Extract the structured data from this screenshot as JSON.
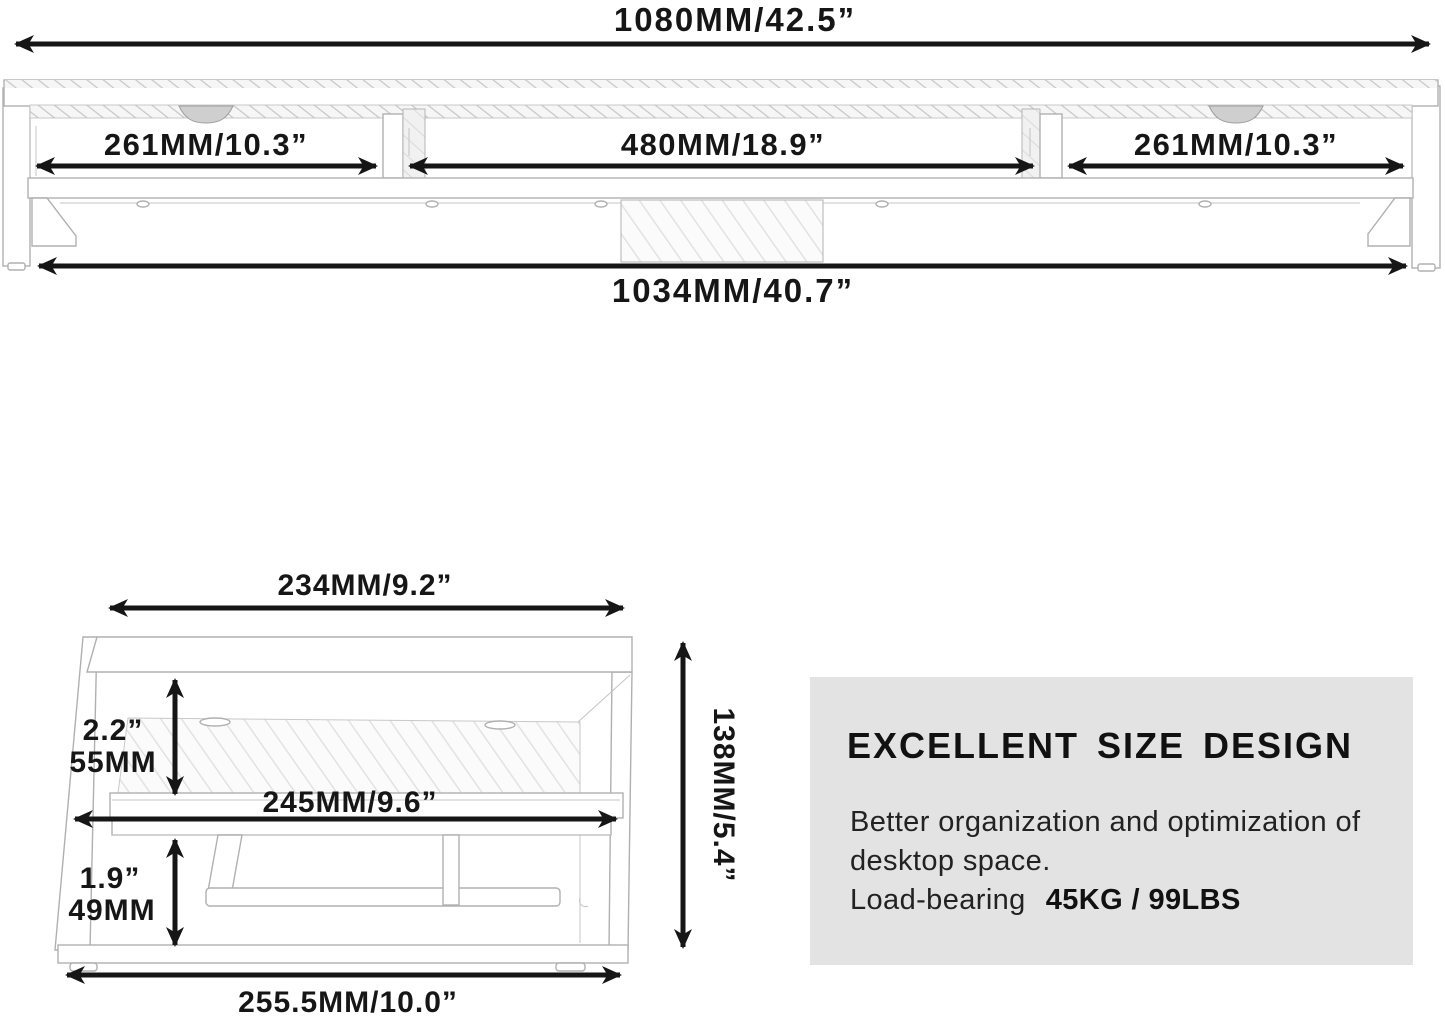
{
  "front_view": {
    "overall_width": "1080MM/42.5”",
    "left_compartment": "261MM/10.3”",
    "center_compartment": "480MM/18.9”",
    "right_compartment": "261MM/10.3”",
    "inner_width": "1034MM/40.7”"
  },
  "side_view": {
    "top_depth": "234MM/9.2”",
    "upper_clearance_in": "2.2”",
    "upper_clearance_mm": "55MM",
    "shelf_depth": "245MM/9.6”",
    "lower_clearance_in": "1.9”",
    "lower_clearance_mm": "49MM",
    "overall_height": "138MM/5.4”",
    "base_depth": "255.5MM/10.0”"
  },
  "info_panel": {
    "heading": "EXCELLENT SIZE DESIGN",
    "line1": "Better organization and optimization of",
    "line2": "desktop space.",
    "line3_label": "Load-bearing",
    "line3_value": "45KG / 99LBS"
  },
  "colors": {
    "dimension_ink": "#161616",
    "structure_line": "#b0b0b0",
    "panel_bg": "#e3e3e3"
  }
}
